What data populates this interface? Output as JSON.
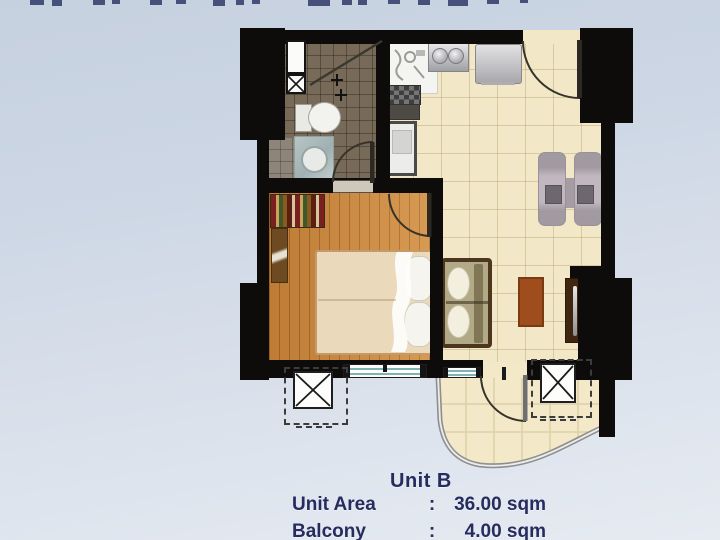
{
  "caption": {
    "unit_name": "Unit B",
    "rows": [
      {
        "label": "Unit Area",
        "sep": ":",
        "value": "36.00 sqm"
      },
      {
        "label": "Balcony",
        "sep": ":",
        "value": "4.00 sqm"
      }
    ]
  },
  "colors": {
    "accent_navy_text": "#262c5e",
    "wall_black": "#0e0c0a",
    "tile_cream": "#f2e8c7",
    "wood_orange": "#cf8a3e",
    "bath_brown": "#786a58",
    "background_blue": "#ccd6e4"
  },
  "icons": [
    "ac-unit-x-symbol",
    "vent-x-symbol",
    "door-swing-arc",
    "shower-partition-line"
  ],
  "top_cropped_text_fragments": [
    [
      30,
      14,
      5
    ],
    [
      52,
      10,
      6
    ],
    [
      93,
      12,
      5
    ],
    [
      112,
      8,
      4
    ],
    [
      150,
      12,
      5
    ],
    [
      176,
      10,
      4
    ],
    [
      213,
      12,
      6
    ],
    [
      236,
      8,
      5
    ],
    [
      252,
      8,
      4
    ],
    [
      308,
      22,
      6
    ],
    [
      342,
      10,
      5
    ],
    [
      358,
      9,
      5
    ],
    [
      388,
      12,
      4
    ],
    [
      418,
      12,
      5
    ],
    [
      448,
      20,
      6
    ],
    [
      487,
      12,
      4
    ],
    [
      520,
      8,
      3
    ]
  ]
}
